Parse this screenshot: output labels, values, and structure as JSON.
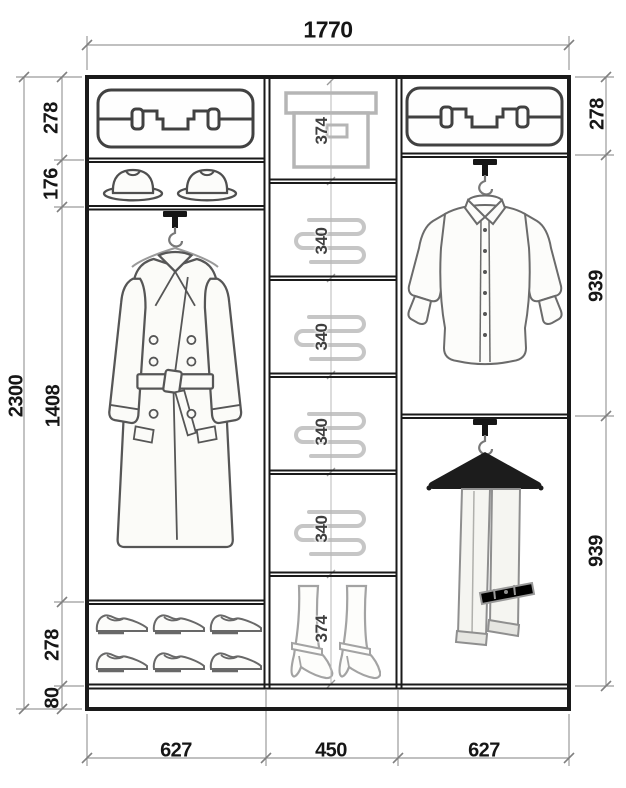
{
  "diagram_type": "wardrobe interior dimension drawing",
  "dims": {
    "total_width": "1770",
    "total_height": "2300",
    "left_rows": [
      "278",
      "176",
      "1408",
      "278",
      "80"
    ],
    "right_rows": [
      "278",
      "939",
      "939"
    ],
    "bottom_columns": [
      "627",
      "450",
      "627"
    ],
    "middle_cells": [
      "374",
      "340",
      "340",
      "340",
      "340",
      "374"
    ]
  },
  "icons": {
    "left_top_shelf": "suitcase-icon",
    "left_second_shelf": "hat-icon",
    "left_hanging_section": "coat-on-hanger-icon",
    "left_bottom_shelf": "shoes-icon",
    "middle_top_cell": "storage-box-icon",
    "middle_shelf_cells": "folded-clothes-icon",
    "middle_bottom_cell": "boots-icon",
    "right_top_shelf": "suitcase-icon",
    "right_upper_section": "shirt-on-hanger-icon",
    "right_lower_section": "trousers-on-hanger-icon"
  },
  "colors": {
    "background": "#ffffff",
    "frame_line": "#1a1a1a",
    "dimension_line": "#9a9a9a",
    "dimension_text": "#161616",
    "middle_dimension_text": "#3f3f3f",
    "icon_outline_dark": "#414141",
    "icon_outline_mid": "#6b6b6b",
    "icon_outline_light": "#c6c6c6"
  }
}
